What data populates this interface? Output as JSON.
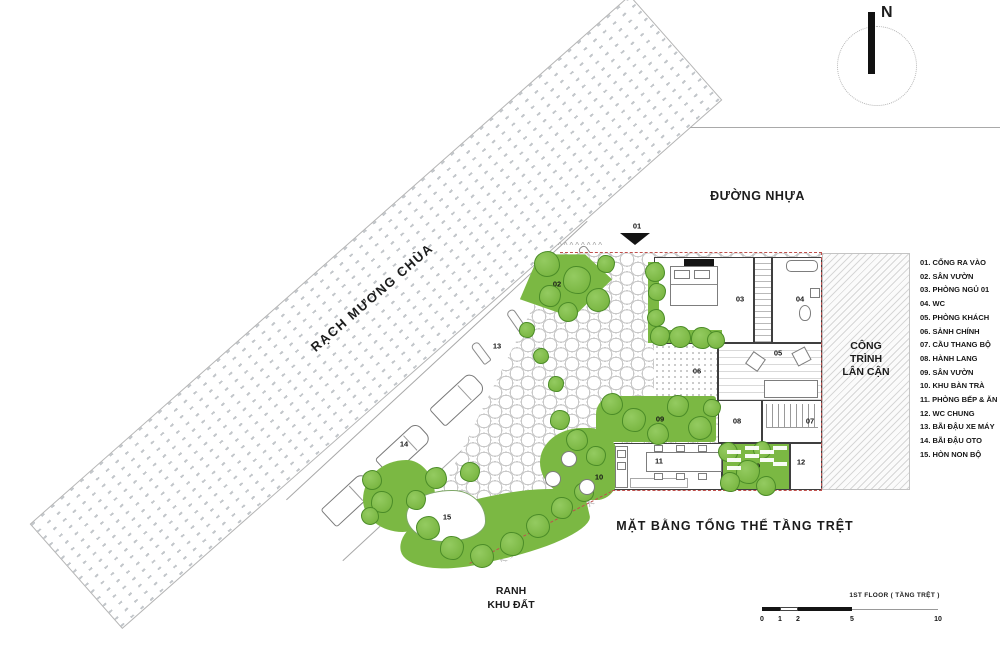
{
  "plan_title": "MẶT BẰNG TỔNG THỂ TẦNG TRỆT",
  "compass": {
    "label": "N"
  },
  "areas": {
    "canal": "RẠCH MƯƠNG CHÙA",
    "road": "ĐƯỜNG NHỰA",
    "adjacent": [
      "CÔNG",
      "TRÌNH",
      "LÂN CẬN"
    ],
    "boundary": [
      "RANH",
      "KHU ĐẤT"
    ],
    "fence_marks": "^^^^^^^^"
  },
  "legend": {
    "items": [
      {
        "num": "01",
        "label": "CỔNG RA VÀO"
      },
      {
        "num": "02",
        "label": "SÂN VƯỜN"
      },
      {
        "num": "03",
        "label": "PHÒNG NGỦ 01"
      },
      {
        "num": "04",
        "label": "WC"
      },
      {
        "num": "05",
        "label": "PHÒNG KHÁCH"
      },
      {
        "num": "06",
        "label": "SẢNH CHÍNH"
      },
      {
        "num": "07",
        "label": "CẦU THANG BỘ"
      },
      {
        "num": "08",
        "label": "HÀNH LANG"
      },
      {
        "num": "09",
        "label": "SÂN VƯỜN"
      },
      {
        "num": "10",
        "label": "KHU BÀN TRÀ"
      },
      {
        "num": "11",
        "label": "PHÒNG BẾP & ĂN"
      },
      {
        "num": "12",
        "label": "WC CHUNG"
      },
      {
        "num": "13",
        "label": "BÃI ĐẬU XE MÁY"
      },
      {
        "num": "14",
        "label": "BÃI ĐẬU OTO"
      },
      {
        "num": "15",
        "label": "HÒN NON BỘ"
      }
    ]
  },
  "plan_markers": [
    {
      "num": "01",
      "x": 637,
      "y": 226
    },
    {
      "num": "02",
      "x": 557,
      "y": 284
    },
    {
      "num": "03",
      "x": 740,
      "y": 299
    },
    {
      "num": "04",
      "x": 800,
      "y": 299
    },
    {
      "num": "05",
      "x": 778,
      "y": 353
    },
    {
      "num": "06",
      "x": 697,
      "y": 371
    },
    {
      "num": "07",
      "x": 810,
      "y": 421
    },
    {
      "num": "08",
      "x": 737,
      "y": 421
    },
    {
      "num": "09",
      "x": 660,
      "y": 419
    },
    {
      "num": "09",
      "x": 756,
      "y": 466
    },
    {
      "num": "10",
      "x": 599,
      "y": 477
    },
    {
      "num": "11",
      "x": 659,
      "y": 461
    },
    {
      "num": "12",
      "x": 801,
      "y": 462
    },
    {
      "num": "13",
      "x": 497,
      "y": 346
    },
    {
      "num": "14",
      "x": 404,
      "y": 444
    },
    {
      "num": "15",
      "x": 447,
      "y": 517
    }
  ],
  "scalebar": {
    "label": "1ST FLOOR ( TẦNG TRỆT )",
    "ticks": [
      {
        "t": "0",
        "x": 0
      },
      {
        "t": "1",
        "x": 18
      },
      {
        "t": "2",
        "x": 36
      },
      {
        "t": "5",
        "x": 90
      },
      {
        "t": "10",
        "x": 176
      }
    ]
  }
}
